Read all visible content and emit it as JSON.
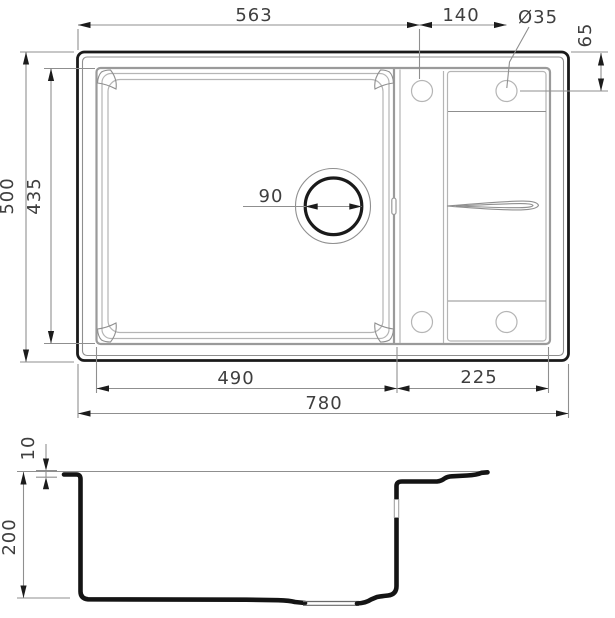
{
  "dims": {
    "rim_to_hole_x": "563",
    "hole_spacing_x": "140",
    "hole_diameter": "Ø35",
    "hole_offset_y": "65",
    "overall_depth": "500",
    "bowl_rim_depth": "435",
    "drain_diameter": "90",
    "bowl_width": "490",
    "drainer_width": "225",
    "overall_width": "780",
    "rim_height": "10",
    "bowl_depth": "200"
  },
  "colors": {
    "line_dark": "#1a1a1a",
    "line_mid": "#8f8f8f",
    "line_light": "#b5b5b5",
    "text": "#3f3f3f",
    "background": "#ffffff"
  }
}
